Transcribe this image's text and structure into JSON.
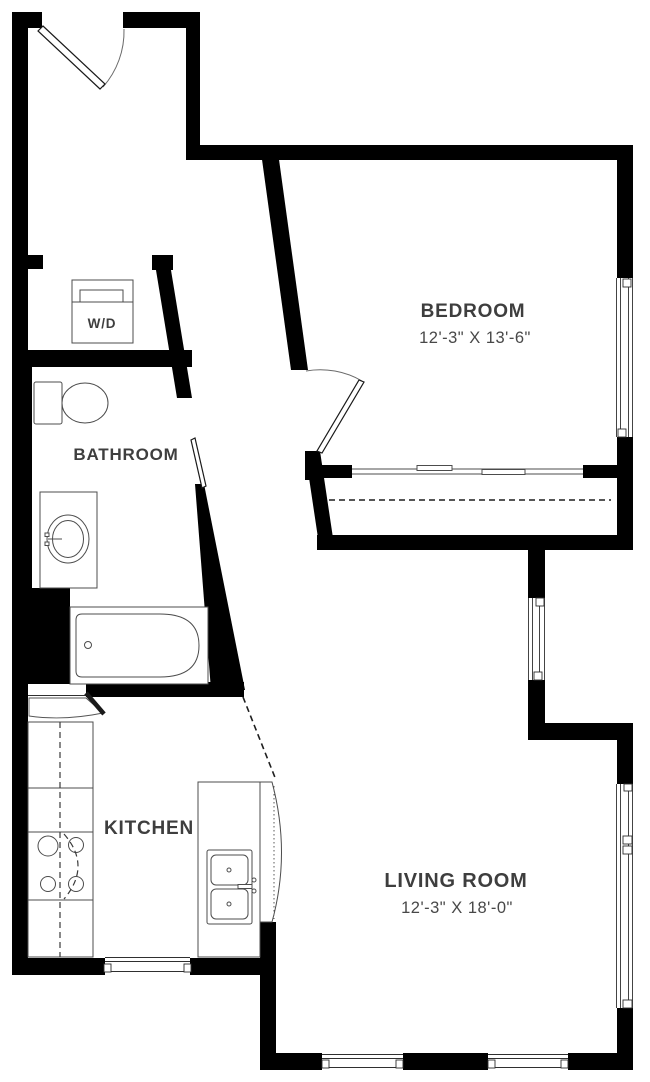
{
  "title": "Apartment Floor Plan",
  "rooms": {
    "bedroom": {
      "label": "BEDROOM",
      "dims": "12'-3\" X 13'-6\""
    },
    "bathroom": {
      "label": "BATHROOM"
    },
    "kitchen": {
      "label": "KITCHEN"
    },
    "living_room": {
      "label": "LIVING ROOM",
      "dims": "12'-3\" X 18'-0\""
    },
    "laundry": {
      "label": "W/D"
    }
  },
  "colors": {
    "wall": "#000000",
    "label_text": "#3e3e3e",
    "dimension_text": "#484848",
    "fixture_line": "#4c4c4c",
    "background": "#ffffff"
  }
}
